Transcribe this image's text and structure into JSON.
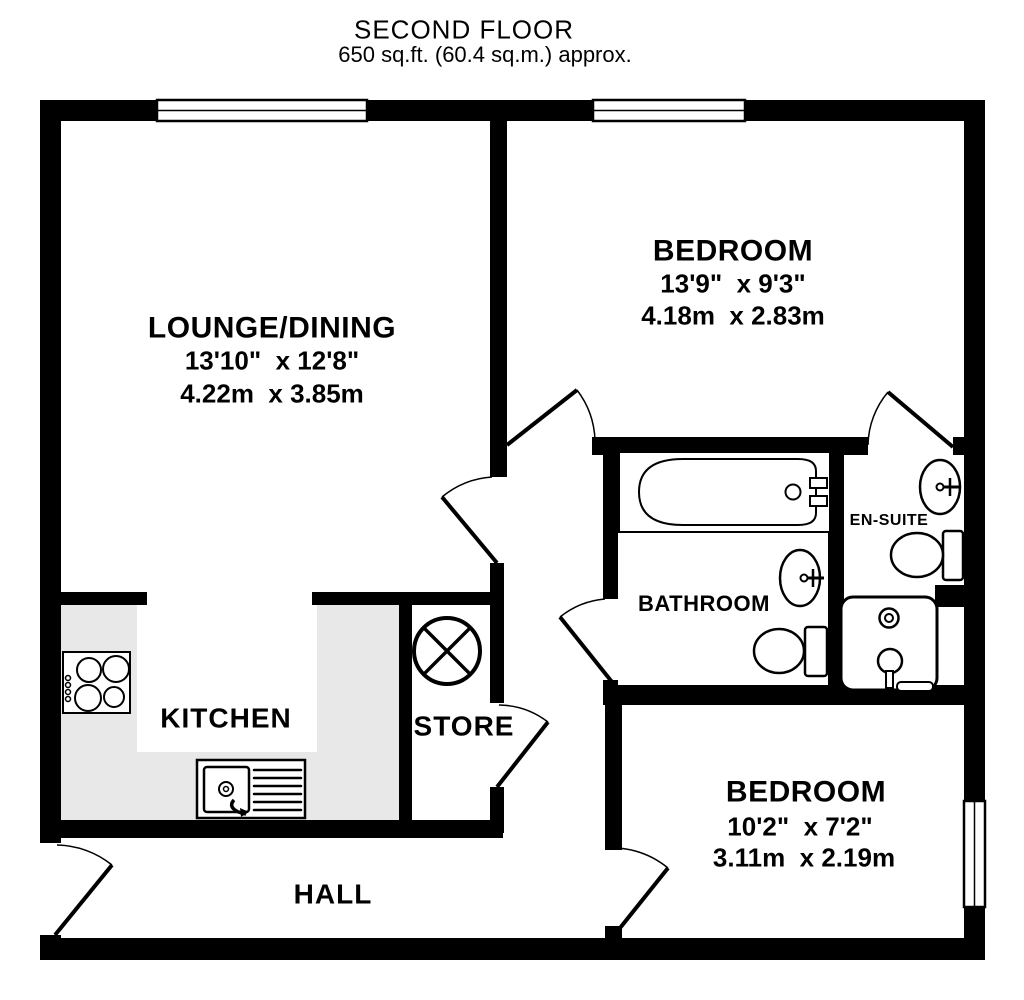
{
  "title": {
    "floor": "SECOND FLOOR",
    "area": "650 sq.ft. (60.4 sq.m.) approx."
  },
  "rooms": {
    "lounge": {
      "name": "LOUNGE/DINING",
      "imperial": "13'10\"  x 12'8\"",
      "metric": "4.22m  x 3.85m"
    },
    "bedroom1": {
      "name": "BEDROOM",
      "imperial": "13'9\"  x 9'3\"",
      "metric": "4.18m  x 2.83m"
    },
    "bedroom2": {
      "name": "BEDROOM",
      "imperial": "10'2\"  x 7'2\"",
      "metric": "3.11m  x 2.19m"
    },
    "kitchen": {
      "name": "KITCHEN"
    },
    "store": {
      "name": "STORE"
    },
    "bathroom": {
      "name": "BATHROOM"
    },
    "ensuite": {
      "name": "EN-SUITE"
    },
    "hall": {
      "name": "HALL"
    }
  },
  "fixtures": [
    "bathtub",
    "washbasin",
    "toilet",
    "shower",
    "water-cylinder",
    "hob",
    "kitchen-sink",
    "door-swing",
    "window"
  ],
  "colors": {
    "wall": "#000000",
    "floor": "#ffffff",
    "kitchen_counter": "#e8e8e8",
    "text": "#000000"
  }
}
